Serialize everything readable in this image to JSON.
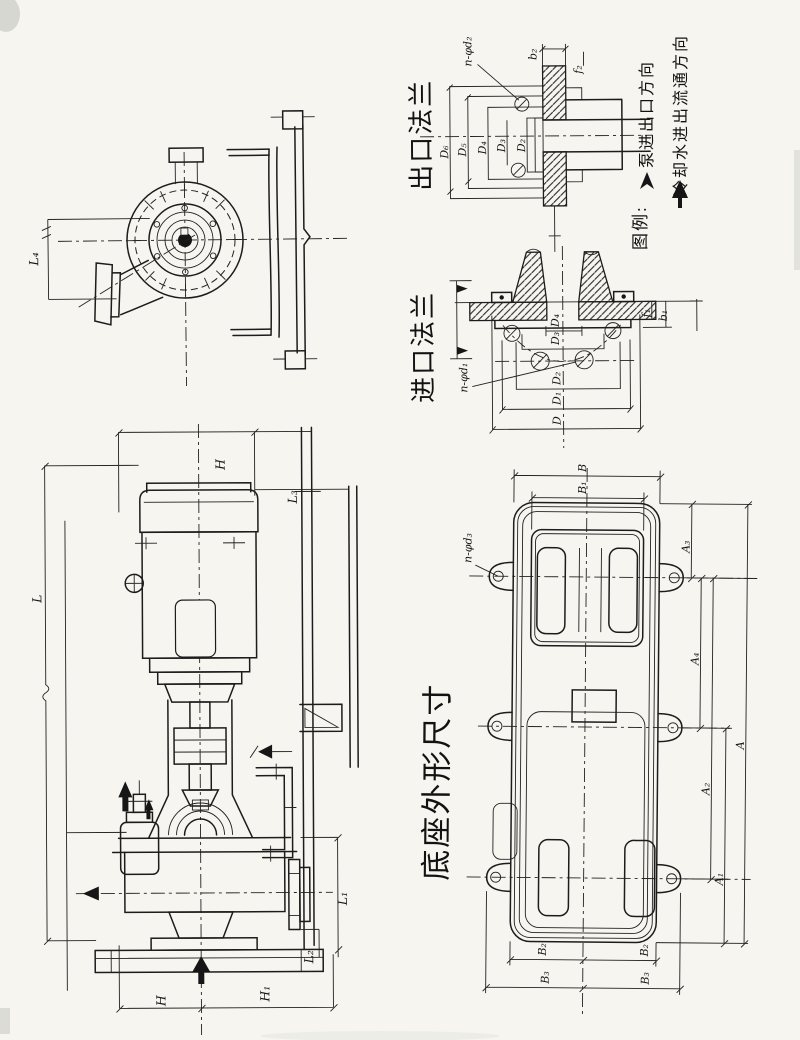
{
  "drawing": {
    "titles": {
      "outlet_flange": "出口法兰",
      "inlet_flange": "进口法兰",
      "base_outline": "底座外形尺寸"
    },
    "legend": {
      "heading": "图例:",
      "pump_flow": "泵进出口方向",
      "cooling_flow": "冷却水进出流通方向"
    },
    "outlet_dims": {
      "d6": "D₆",
      "d5": "D₅",
      "d4": "D₄",
      "d3": "D₃",
      "d2": "D₂",
      "holes": "n-φd₂",
      "b2": "b₂",
      "f2": "f₂"
    },
    "inlet_dims": {
      "d": "D",
      "d1": "D₁",
      "d2": "D₂",
      "d3": "D₃",
      "d4": "D₄",
      "holes": "n-φd₁",
      "b1": "b₁",
      "f1": "f₁"
    },
    "side_dims": {
      "h": "H",
      "h1": "H₁",
      "l": "L",
      "l1": "L₁",
      "l2": "L₂",
      "l3": "L₃",
      "l4": "L₄"
    },
    "base_dims": {
      "a": "A",
      "a1": "A₁",
      "a2": "A₂",
      "a3": "A₃",
      "a4": "A₄",
      "b": "B",
      "b1": "B₁",
      "b2": "B₂",
      "b3": "B₃",
      "holes": "n-φd₃"
    }
  },
  "colors": {
    "paper": "#f6f5f0",
    "ink": "#1c1c1c"
  }
}
